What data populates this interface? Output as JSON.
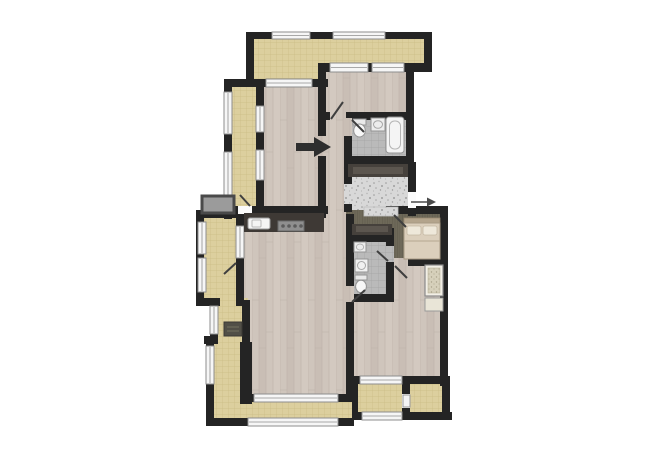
{
  "canvas": {
    "width": 650,
    "height": 459,
    "background": "#ffffff"
  },
  "palette": {
    "wall": "#242424",
    "wood_floor": "#cfc5bc",
    "balcony_tile": "#dccf9e",
    "bath_tile": "#bababa",
    "hall_dark_floor": "#6e6959",
    "entry_granite": "#d8d8d8",
    "counter": "#3e3935",
    "window_fill": "#f6f6f6",
    "window_frame": "#8e8e8e",
    "door": "#3f3f3f",
    "arrow": "#2e2e2e"
  },
  "floors": [
    {
      "name": "living-room-floor",
      "fill": "wood",
      "r": [
        238,
        208,
        114,
        192
      ]
    },
    {
      "name": "bedroom-a-floor",
      "fill": "wood",
      "r": [
        258,
        80,
        66,
        132
      ]
    },
    {
      "name": "bedroom-b-floor",
      "fill": "wood",
      "r": [
        322,
        66,
        90,
        52
      ]
    },
    {
      "name": "hallway-floor",
      "fill": "wood",
      "r": [
        314,
        110,
        36,
        110
      ]
    },
    {
      "name": "bedroom-c-floor",
      "fill": "wood",
      "r": [
        350,
        260,
        94,
        122
      ]
    },
    {
      "name": "terrace-top-floor",
      "fill": "tan",
      "points": "250,36 428,36 428,70 324,70 324,84 250,84"
    },
    {
      "name": "balcony-left-floor",
      "fill": "tan",
      "r": [
        226,
        80,
        36,
        136
      ]
    },
    {
      "name": "balcony-left-2-floor",
      "fill": "tan",
      "r": [
        198,
        212,
        44,
        94
      ]
    },
    {
      "name": "balcony-left-3-floor",
      "fill": "tan",
      "r": [
        210,
        298,
        38,
        48
      ]
    },
    {
      "name": "balcony-bottom-floor",
      "fill": "tan",
      "points": "206,340 248,340 248,398 352,398 352,422 206,422"
    },
    {
      "name": "balcony-bottom-right-1-floor",
      "fill": "tan",
      "r": [
        354,
        378,
        52,
        40
      ]
    },
    {
      "name": "balcony-bottom-right-2-floor",
      "fill": "tan",
      "r": [
        406,
        378,
        42,
        40
      ]
    },
    {
      "name": "inner-hall-floor",
      "fill": "olive",
      "r": [
        346,
        202,
        66,
        40
      ]
    },
    {
      "name": "bedroom-2-floor",
      "fill": "olive",
      "r": [
        388,
        208,
        56,
        54
      ]
    },
    {
      "name": "bathroom-1-floor",
      "fill": "gray_tile",
      "r": [
        348,
        114,
        62,
        48
      ]
    },
    {
      "name": "bathroom-2-floor",
      "fill": "gray_tile",
      "r": [
        350,
        236,
        42,
        62
      ]
    },
    {
      "name": "entry-hall-floor",
      "fill": "granite",
      "r": [
        348,
        174,
        64,
        36
      ]
    }
  ],
  "walls": [
    [
      246,
      32,
      186,
      7
    ],
    [
      246,
      32,
      8,
      54
    ],
    [
      424,
      32,
      8,
      40
    ],
    [
      318,
      63,
      114,
      9
    ],
    [
      318,
      63,
      8,
      23
    ],
    [
      224,
      79,
      104,
      8
    ],
    [
      224,
      79,
      8,
      140
    ],
    [
      256,
      84,
      8,
      128
    ],
    [
      318,
      84,
      8,
      52
    ],
    [
      318,
      156,
      8,
      62
    ],
    [
      406,
      63,
      8,
      102
    ],
    [
      326,
      112,
      88,
      8
    ],
    [
      344,
      112,
      8,
      6
    ],
    [
      344,
      136,
      8,
      28
    ],
    [
      344,
      156,
      68,
      8
    ],
    [
      344,
      160,
      8,
      24
    ],
    [
      344,
      204,
      8,
      8
    ],
    [
      408,
      162,
      8,
      30
    ],
    [
      408,
      206,
      8,
      10
    ],
    [
      224,
      206,
      104,
      8
    ],
    [
      196,
      210,
      46,
      8
    ],
    [
      196,
      212,
      8,
      94
    ],
    [
      236,
      212,
      8,
      94
    ],
    [
      196,
      298,
      24,
      8
    ],
    [
      210,
      300,
      8,
      44
    ],
    [
      242,
      300,
      8,
      46
    ],
    [
      204,
      336,
      14,
      8
    ],
    [
      206,
      340,
      8,
      86
    ],
    [
      240,
      342,
      12,
      62
    ],
    [
      244,
      394,
      114,
      8
    ],
    [
      206,
      418,
      148,
      8
    ],
    [
      346,
      214,
      8,
      72
    ],
    [
      346,
      302,
      8,
      100
    ],
    [
      346,
      234,
      48,
      8
    ],
    [
      386,
      228,
      8,
      20
    ],
    [
      386,
      262,
      8,
      38
    ],
    [
      346,
      294,
      48,
      8
    ],
    [
      386,
      206,
      62,
      8
    ],
    [
      440,
      206,
      8,
      180
    ],
    [
      386,
      258,
      62,
      8
    ],
    [
      348,
      376,
      102,
      8
    ],
    [
      352,
      380,
      6,
      40
    ],
    [
      402,
      380,
      8,
      36
    ],
    [
      442,
      380,
      8,
      40
    ],
    [
      352,
      412,
      100,
      8
    ]
  ],
  "windows": [
    [
      272,
      32,
      38,
      7,
      "h"
    ],
    [
      333,
      32,
      52,
      7,
      "h"
    ],
    [
      266,
      79,
      46,
      8,
      "h"
    ],
    [
      330,
      63,
      38,
      9,
      "h"
    ],
    [
      372,
      63,
      32,
      9,
      "h"
    ],
    [
      254,
      394,
      84,
      8,
      "h"
    ],
    [
      248,
      418,
      90,
      8,
      "h"
    ],
    [
      360,
      376,
      42,
      8,
      "h"
    ],
    [
      362,
      412,
      40,
      8,
      "h"
    ],
    [
      224,
      92,
      8,
      42,
      "v"
    ],
    [
      224,
      152,
      8,
      48,
      "v"
    ],
    [
      256,
      106,
      8,
      26,
      "v"
    ],
    [
      256,
      150,
      8,
      30,
      "v"
    ],
    [
      198,
      222,
      8,
      32,
      "v"
    ],
    [
      198,
      258,
      8,
      34,
      "v"
    ],
    [
      236,
      226,
      8,
      32,
      "v"
    ],
    [
      210,
      306,
      8,
      28,
      "v"
    ],
    [
      206,
      346,
      8,
      38,
      "v"
    ]
  ],
  "door_gaps": [
    [
      238,
      206,
      14,
      8,
      "#fbfbfb"
    ],
    [
      330,
      112,
      16,
      8,
      "wood"
    ],
    [
      344,
      118,
      8,
      18,
      "wood"
    ],
    [
      344,
      184,
      8,
      20,
      "granite"
    ],
    [
      408,
      192,
      8,
      16,
      "#fbfbfb"
    ],
    [
      386,
      214,
      8,
      14,
      "olive"
    ],
    [
      386,
      246,
      8,
      16,
      "gray_tile"
    ],
    [
      346,
      286,
      8,
      16,
      "wood"
    ],
    [
      394,
      258,
      14,
      8,
      "wood"
    ],
    [
      402,
      394,
      8,
      14,
      "#fbfbfb"
    ]
  ],
  "doors": [
    [
      250,
      206,
      240,
      195
    ],
    [
      331,
      119,
      343,
      102
    ],
    [
      352,
      120,
      364,
      132
    ],
    [
      236,
      263,
      224,
      274
    ],
    [
      352,
      302,
      365,
      290
    ],
    [
      388,
      261,
      377,
      251
    ],
    [
      394,
      215,
      406,
      227
    ],
    [
      395,
      266,
      407,
      278
    ]
  ],
  "fixtures": [
    {
      "name": "utility-platform",
      "s": "rect",
      "r": [
        202,
        196,
        32,
        17
      ],
      "f": "#9b9b9b",
      "st": "#4a4a4a",
      "sw": 3
    },
    {
      "name": "kitchen-counter",
      "s": "rect",
      "r": [
        244,
        213,
        80,
        19
      ],
      "f": "#3e3935"
    },
    {
      "name": "kitchen-sink",
      "s": "rect",
      "r": [
        248,
        218,
        22,
        11
      ],
      "f": "#f4f4f4",
      "st": "#9a9a9a",
      "sw": 1,
      "rx": 2
    },
    {
      "name": "kitchen-sink-bowl",
      "s": "rect",
      "r": [
        252,
        220,
        9,
        7
      ],
      "f": "none",
      "st": "#b9b9b9",
      "sw": 1,
      "rx": 1
    },
    {
      "name": "cooktop",
      "s": "rect",
      "r": [
        278,
        221,
        26,
        10
      ],
      "f": "#8f8f8f",
      "st": "#6a6a6a",
      "sw": 1
    },
    {
      "name": "burner",
      "s": "circle",
      "c": [
        283,
        226,
        1.8
      ],
      "f": "#5c5c5c"
    },
    {
      "name": "burner",
      "s": "circle",
      "c": [
        289,
        226,
        1.8
      ],
      "f": "#5c5c5c"
    },
    {
      "name": "burner",
      "s": "circle",
      "c": [
        295,
        226,
        1.8
      ],
      "f": "#5c5c5c"
    },
    {
      "name": "burner",
      "s": "circle",
      "c": [
        301,
        226,
        1.8
      ],
      "f": "#5c5c5c"
    },
    {
      "name": "hall-wardrobe",
      "s": "rect",
      "r": [
        348,
        164,
        60,
        13
      ],
      "f": "#46413c"
    },
    {
      "name": "hall-wardrobe-inner",
      "s": "rect",
      "r": [
        353,
        167,
        50,
        7
      ],
      "f": "#5c564f"
    },
    {
      "name": "hall-wardrobe-2",
      "s": "rect",
      "r": [
        352,
        224,
        40,
        11
      ],
      "f": "#46413c"
    },
    {
      "name": "hall-wardrobe-2-inner",
      "s": "rect",
      "r": [
        356,
        226,
        32,
        6
      ],
      "f": "#5c564f"
    },
    {
      "name": "entry-mat",
      "s": "rect",
      "r": [
        364,
        207,
        34,
        9
      ],
      "f": "granite",
      "st": "#c0c0c0",
      "sw": 0.8
    },
    {
      "name": "toilet-1-tank",
      "s": "rect",
      "r": [
        353,
        119,
        13,
        6
      ],
      "f": "#e9e9e9",
      "st": "#949494",
      "sw": 1
    },
    {
      "name": "toilet-1-bowl",
      "s": "ellipse",
      "e": [
        359.5,
        130.5,
        5.8,
        6.5
      ],
      "f": "#f7f7f7",
      "st": "#949494",
      "sw": 1
    },
    {
      "name": "sink-1",
      "s": "rect",
      "r": [
        371,
        118,
        14,
        13
      ],
      "f": "#ededed",
      "st": "#949494",
      "sw": 1
    },
    {
      "name": "sink-1-basin",
      "s": "ellipse",
      "e": [
        378,
        124.5,
        4.5,
        3.8
      ],
      "f": "none",
      "st": "#a8a8a8",
      "sw": 1
    },
    {
      "name": "bathtub",
      "s": "rect",
      "r": [
        386,
        117,
        18,
        36
      ],
      "f": "#f4f4f4",
      "st": "#949494",
      "sw": 1,
      "rx": 3
    },
    {
      "name": "bathtub-inner",
      "s": "rect",
      "r": [
        389.5,
        121,
        11,
        28
      ],
      "f": "none",
      "st": "#b5b5b5",
      "sw": 1,
      "rx": 5
    },
    {
      "name": "bed-headboard",
      "s": "rect",
      "r": [
        404,
        218,
        36,
        5
      ],
      "f": "#b3a48c",
      "st": "#97886f",
      "sw": 0.8
    },
    {
      "name": "bed",
      "s": "rect",
      "r": [
        404,
        223,
        36,
        36
      ],
      "f": "#dbcfbc",
      "st": "#a79a83",
      "sw": 1
    },
    {
      "name": "bed-pillow",
      "s": "rect",
      "r": [
        407,
        226,
        14,
        9
      ],
      "f": "#eee8da",
      "st": "#c4b8a3",
      "sw": 0.8,
      "rx": 2
    },
    {
      "name": "bed-pillow",
      "s": "rect",
      "r": [
        423,
        226,
        14,
        9
      ],
      "f": "#eee8da",
      "st": "#c4b8a3",
      "sw": 0.8,
      "rx": 2
    },
    {
      "name": "bed-blanket-line",
      "s": "line",
      "l": [
        404,
        241,
        440,
        241
      ],
      "st": "#b5a78f",
      "sw": 1
    },
    {
      "name": "sink-2",
      "s": "rect",
      "r": [
        354,
        242,
        12,
        10
      ],
      "f": "#ededed",
      "st": "#949494",
      "sw": 1
    },
    {
      "name": "sink-2-basin",
      "s": "ellipse",
      "e": [
        360,
        247,
        3.6,
        3
      ],
      "f": "none",
      "st": "#a8a8a8",
      "sw": 0.8
    },
    {
      "name": "washing-machine",
      "s": "rect",
      "r": [
        355,
        259,
        13,
        13
      ],
      "f": "#f1f1f1",
      "st": "#949494",
      "sw": 1
    },
    {
      "name": "washing-machine-drum",
      "s": "circle",
      "c": [
        361.5,
        265.5,
        4
      ],
      "f": "none",
      "st": "#a8a8a8",
      "sw": 1
    },
    {
      "name": "toilet-2-tank",
      "s": "rect",
      "r": [
        355,
        275,
        12,
        5
      ],
      "f": "#e9e9e9",
      "st": "#949494",
      "sw": 1
    },
    {
      "name": "toilet-2-bowl",
      "s": "ellipse",
      "e": [
        361,
        286.5,
        5.4,
        6.2
      ],
      "f": "#f7f7f7",
      "st": "#949494",
      "sw": 1
    },
    {
      "name": "closet-unit",
      "s": "rect",
      "r": [
        425,
        265,
        18,
        31
      ],
      "f": "#f2efe6",
      "st": "#8a8a8a",
      "sw": 1.2
    },
    {
      "name": "closet-unit-shelves",
      "s": "rect",
      "r": [
        428,
        268,
        12,
        25
      ],
      "f": "shelf",
      "st": "#b0a98f",
      "sw": 0.5
    },
    {
      "name": "closet-unit-2",
      "s": "rect",
      "r": [
        425,
        298,
        18,
        13
      ],
      "f": "#e9e5d7",
      "st": "#9a9a9a",
      "sw": 1
    },
    {
      "name": "ac-unit",
      "s": "rect",
      "r": [
        224,
        322,
        18,
        14
      ],
      "f": "#514f47",
      "st": "#3c3a34",
      "sw": 1
    },
    {
      "name": "ac-unit-vent",
      "s": "line",
      "l": [
        227,
        327,
        239,
        327
      ],
      "st": "#73705f",
      "sw": 1
    },
    {
      "name": "ac-unit-vent",
      "s": "line",
      "l": [
        227,
        331,
        239,
        331
      ],
      "st": "#73705f",
      "sw": 1
    },
    {
      "name": "balcony-divider-door",
      "s": "rect",
      "r": [
        403,
        395,
        7,
        12
      ],
      "f": "#f4f4f4",
      "st": "#9a9a9a",
      "sw": 1
    },
    {
      "name": "direction-arrow",
      "s": "polygon",
      "points": "296,143 314,143 314,137 331,147 314,157 314,151 296,151",
      "f": "#2e2e2e"
    },
    {
      "name": "entrance-arrow-line",
      "s": "line",
      "l": [
        411,
        202,
        428,
        202
      ],
      "st": "#4a4a4a",
      "sw": 1.4
    },
    {
      "name": "entrance-arrow-head",
      "s": "polygon",
      "points": "436,202 427,197.5 427,206.5",
      "f": "#4a4a4a"
    }
  ]
}
